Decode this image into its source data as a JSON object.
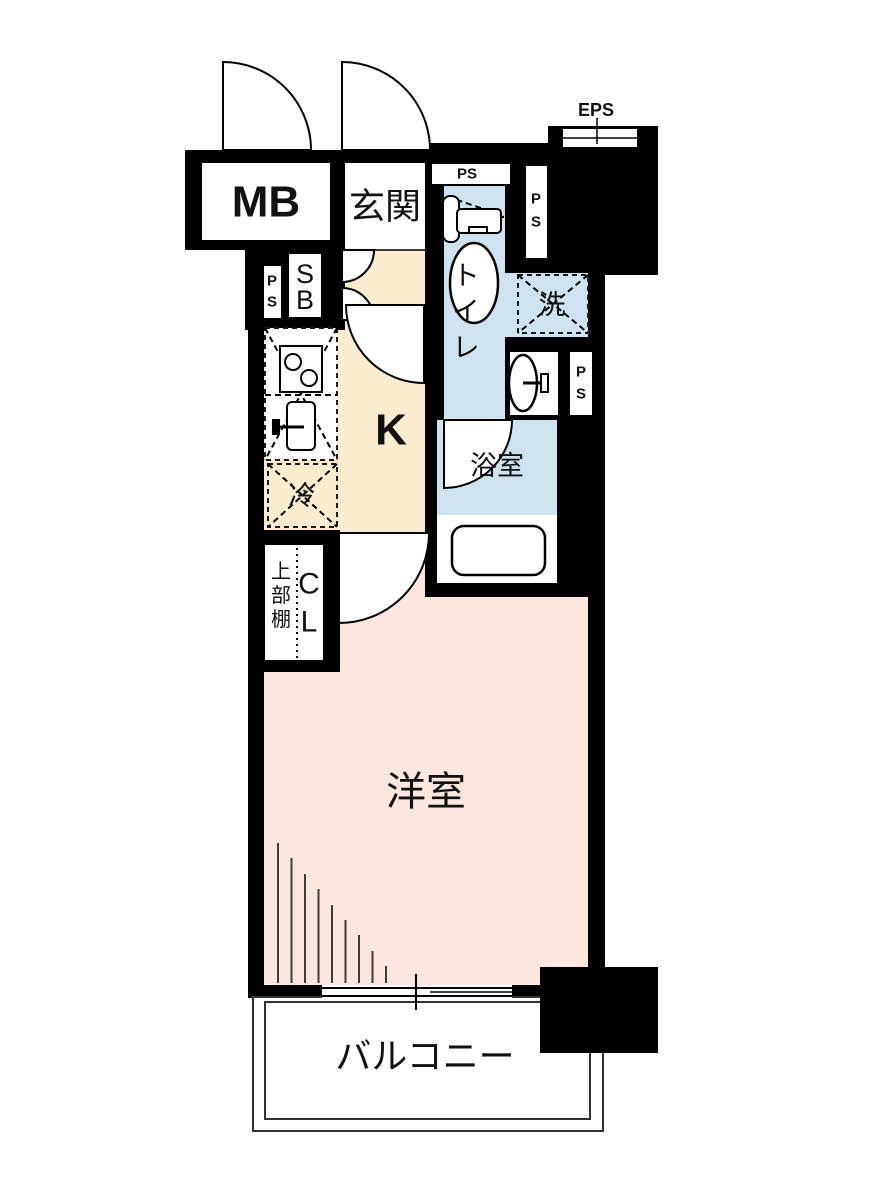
{
  "title": "apartment-floor-plan",
  "colors": {
    "wall": "#000000",
    "background": "#ffffff",
    "kitchen_floor": "#f9ecd0",
    "wet_floor": "#cfe2f0",
    "room_floor": "#fce6e0"
  },
  "labels": {
    "meter_box": "MB",
    "entrance": "玄関",
    "eps": "EPS",
    "ps_h": "PS",
    "ps_p": "P",
    "ps_s": "S",
    "shoe_box_s": "S",
    "shoe_box_b": "B",
    "toilet_1": "ト",
    "toilet_2": "イ",
    "toilet_3": "レ",
    "washer": "洗",
    "kitchen": "K",
    "fridge": "冷",
    "bathroom": "浴室",
    "closet_c": "C",
    "closet_l": "L",
    "shelf_1": "上",
    "shelf_2": "部",
    "shelf_3": "棚",
    "western_room": "洋室",
    "balcony": "バルコニー"
  }
}
